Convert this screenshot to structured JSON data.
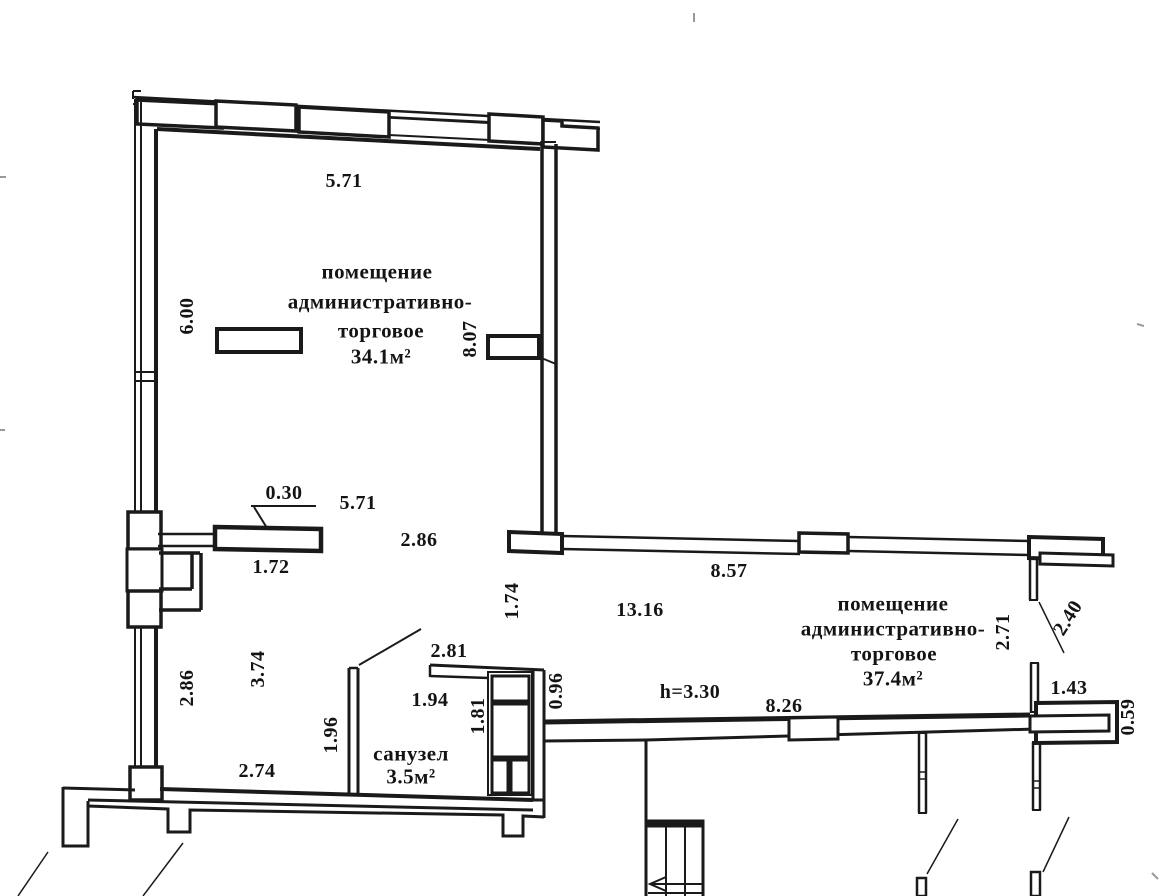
{
  "plan": {
    "type": "floor-plan-scan",
    "rooms": [
      {
        "name_lines": [
          "помещение",
          "административно-",
          "торговое"
        ],
        "area": "34.1м²"
      },
      {
        "name_lines": [
          "помещение",
          "административно-",
          "торговое"
        ],
        "area": "37.4м²"
      },
      {
        "name_lines": [
          "санузел"
        ],
        "area": "3.5м²"
      }
    ],
    "ceiling_height_note": "h=3.30",
    "dimensions_listed": [
      "5.71",
      "6.00",
      "8.07",
      "0.30",
      "5.71",
      "2.86",
      "1.72",
      "1.74",
      "8.57",
      "13.16",
      "2.71",
      "2.40",
      "2.86",
      "3.74",
      "2.81",
      "1.96",
      "1.94",
      "1.81",
      "0.96",
      "8.26",
      "2.74",
      "1.43",
      "0.59"
    ],
    "ink_color": "#1a1a1a",
    "paper_color": "#ffffff"
  },
  "labels": [
    {
      "id": "dim-top-5-71",
      "t": "5.71",
      "x": 344,
      "y": 181
    },
    {
      "id": "dim-6-00",
      "t": "6.00",
      "x": 187,
      "y": 316,
      "rot": -90
    },
    {
      "id": "dim-8-07",
      "t": "8.07",
      "x": 470,
      "y": 339,
      "rot": -90
    },
    {
      "id": "room1-name-line1",
      "t": "помещение",
      "x": 377,
      "y": 272,
      "fs": 21
    },
    {
      "id": "room1-name-line2",
      "t": "административно-",
      "x": 380,
      "y": 302,
      "fs": 21
    },
    {
      "id": "room1-name-line3",
      "t": "торговое",
      "x": 381,
      "y": 331,
      "fs": 21
    },
    {
      "id": "room1-area",
      "t": "34.1м²",
      "x": 381,
      "y": 357,
      "fs": 21
    },
    {
      "id": "dim-0-30",
      "t": "0.30",
      "x": 284,
      "y": 493
    },
    {
      "id": "dim-mid-5-71",
      "t": "5.71",
      "x": 358,
      "y": 503
    },
    {
      "id": "dim-mid-2-86",
      "t": "2.86",
      "x": 419,
      "y": 540
    },
    {
      "id": "dim-1-72",
      "t": "1.72",
      "x": 271,
      "y": 567
    },
    {
      "id": "dim-1-74",
      "t": "1.74",
      "x": 512,
      "y": 601,
      "rot": -90
    },
    {
      "id": "dim-8-57",
      "t": "8.57",
      "x": 729,
      "y": 571
    },
    {
      "id": "dim-13-16",
      "t": "13.16",
      "x": 640,
      "y": 610
    },
    {
      "id": "room2-name-line1",
      "t": "помещение",
      "x": 893,
      "y": 604,
      "fs": 21
    },
    {
      "id": "room2-name-line2",
      "t": "административно-",
      "x": 893,
      "y": 629,
      "fs": 21
    },
    {
      "id": "room2-name-line3",
      "t": "торговое",
      "x": 894,
      "y": 654,
      "fs": 21
    },
    {
      "id": "room2-area",
      "t": "37.4м²",
      "x": 893,
      "y": 679,
      "fs": 21
    },
    {
      "id": "dim-2-71",
      "t": "2.71",
      "x": 1003,
      "y": 632,
      "rot": -90
    },
    {
      "id": "dim-2-40",
      "t": "2.40",
      "x": 1068,
      "y": 618,
      "rot": -58
    },
    {
      "id": "dim-left-2-86",
      "t": "2.86",
      "x": 187,
      "y": 688,
      "rot": -90
    },
    {
      "id": "dim-3-74",
      "t": "3.74",
      "x": 258,
      "y": 669,
      "rot": -90
    },
    {
      "id": "dim-2-81",
      "t": "2.81",
      "x": 449,
      "y": 651
    },
    {
      "id": "dim-1-96",
      "t": "1.96",
      "x": 331,
      "y": 735,
      "rot": -90
    },
    {
      "id": "dim-1-94",
      "t": "1.94",
      "x": 430,
      "y": 700
    },
    {
      "id": "dim-1-81",
      "t": "1.81",
      "x": 478,
      "y": 716,
      "rot": -90
    },
    {
      "id": "dim-0-96",
      "t": "0.96",
      "x": 556,
      "y": 691,
      "rot": -90
    },
    {
      "id": "height-note",
      "t": "h=3.30",
      "x": 690,
      "y": 692
    },
    {
      "id": "dim-8-26",
      "t": "8.26",
      "x": 784,
      "y": 706
    },
    {
      "id": "bathroom-name",
      "t": "санузел",
      "x": 411,
      "y": 754,
      "fs": 21
    },
    {
      "id": "bathroom-area",
      "t": "3.5м²",
      "x": 411,
      "y": 777,
      "fs": 21
    },
    {
      "id": "dim-2-74",
      "t": "2.74",
      "x": 257,
      "y": 771
    },
    {
      "id": "dim-1-43",
      "t": "1.43",
      "x": 1069,
      "y": 688
    },
    {
      "id": "dim-0-59",
      "t": "0.59",
      "x": 1128,
      "y": 717,
      "rot": -90
    }
  ]
}
